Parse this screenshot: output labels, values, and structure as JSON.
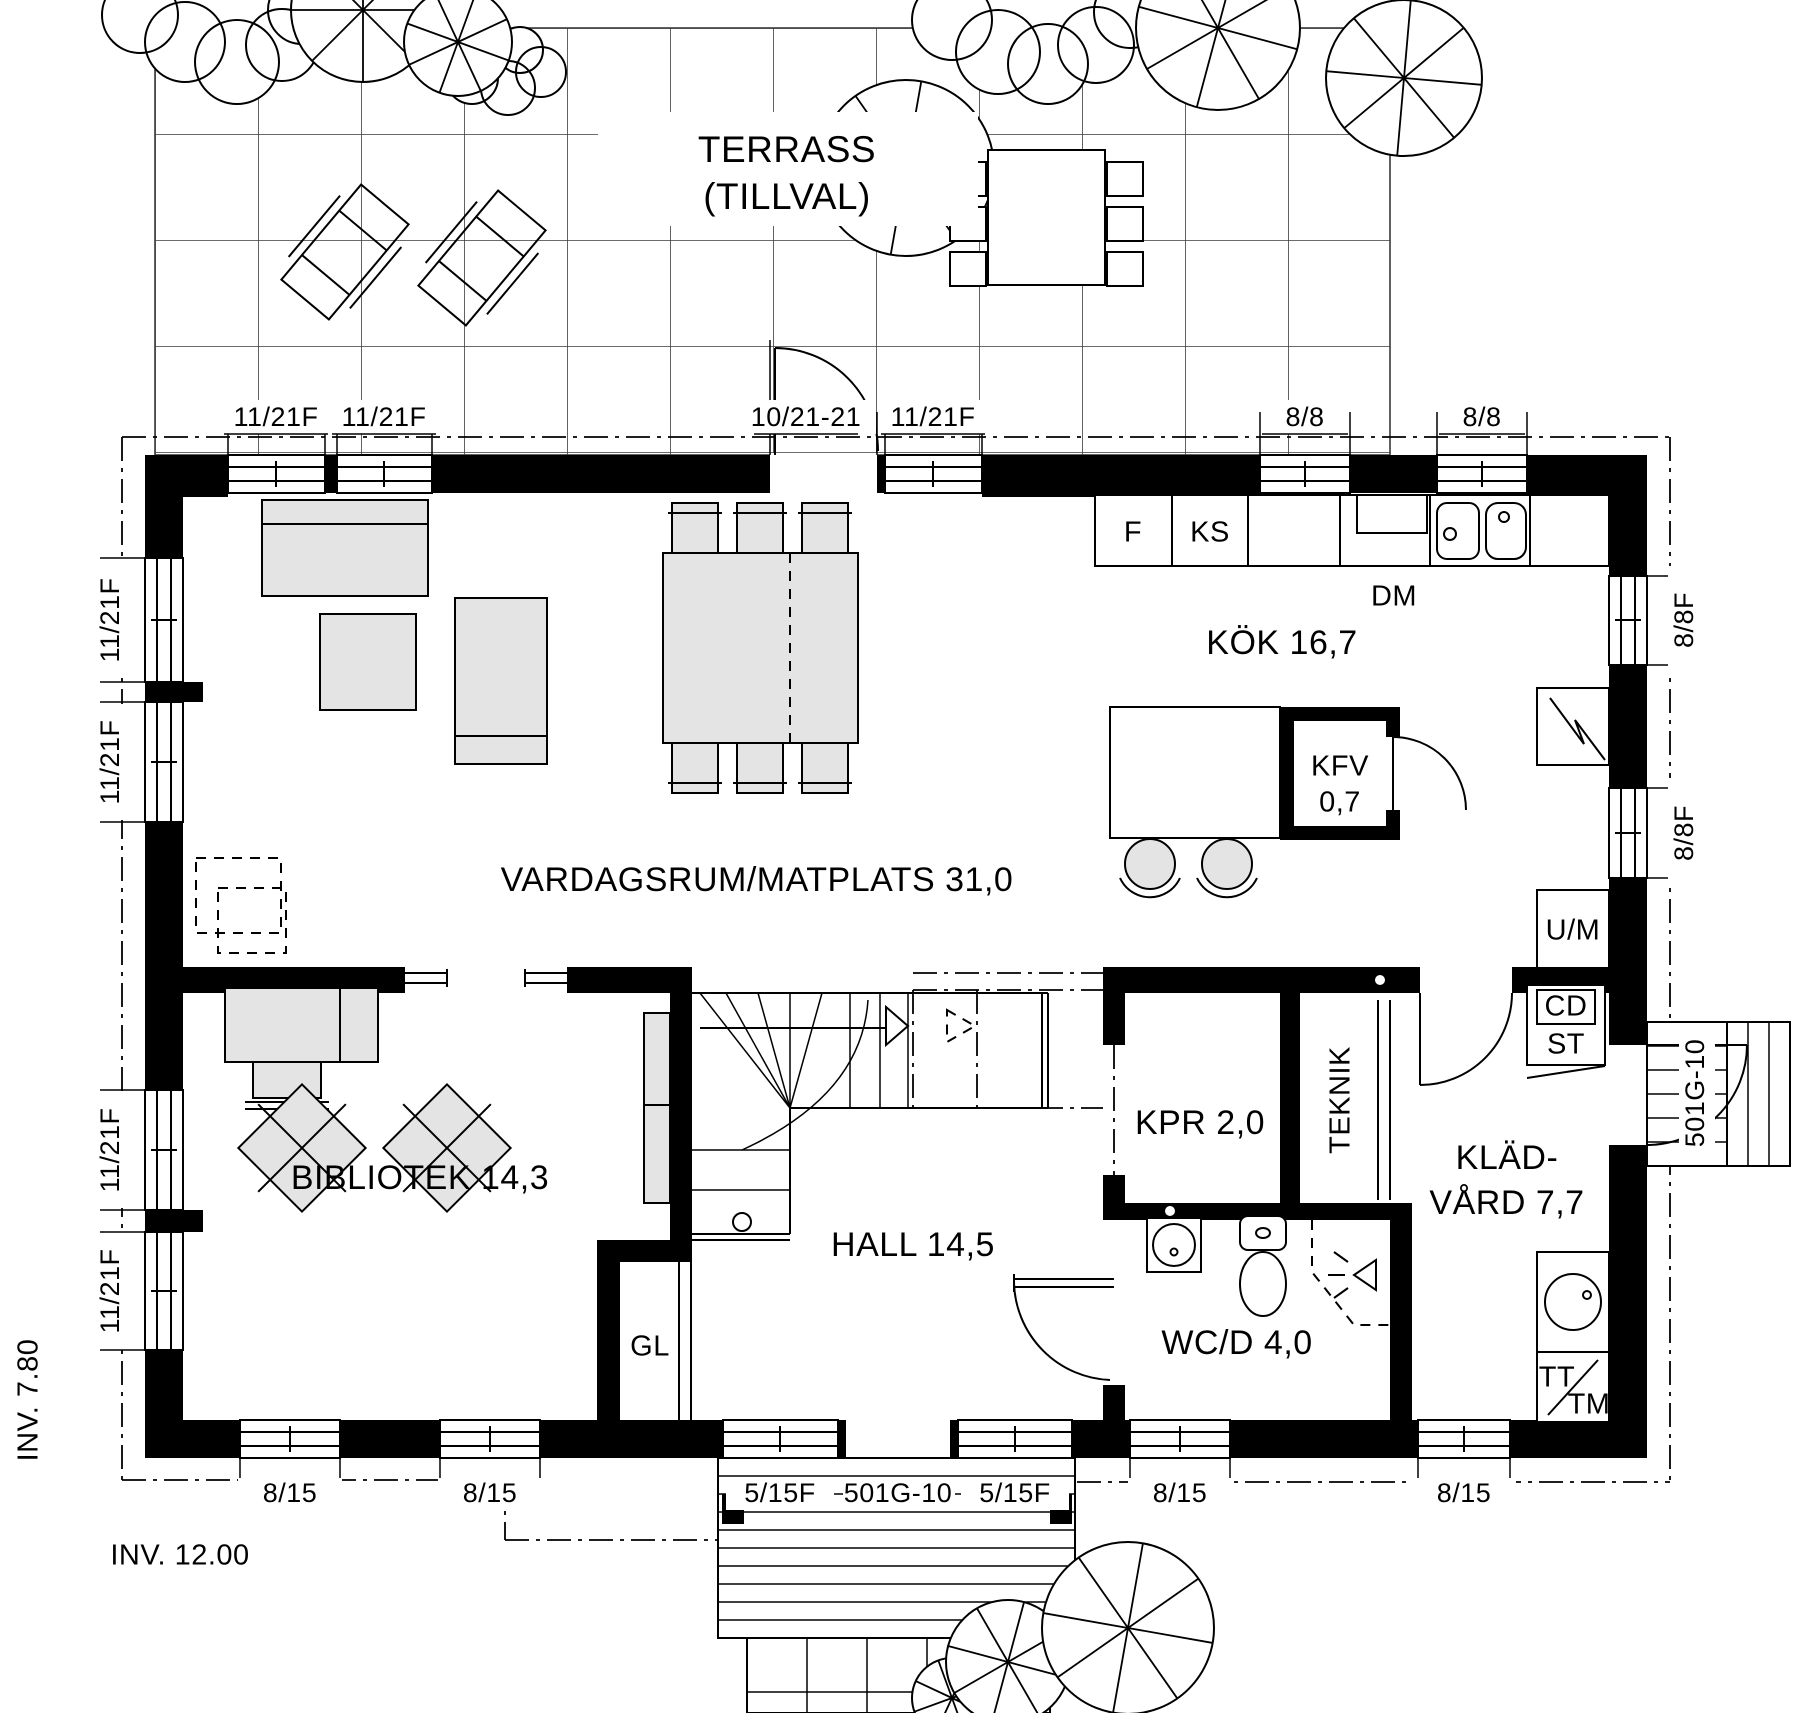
{
  "terrace": {
    "line1": "TERRASS",
    "line2": "(TILLVAL)"
  },
  "rooms": {
    "living": "VARDAGSRUM/MATPLATS 31,0",
    "kitchen": "KÖK 16,7",
    "library": "BIBLIOTEK 14,3",
    "hall": "HALL 14,5",
    "kpr": "KPR 2,0",
    "teknik": "TEKNIK",
    "kladvard1": "KLÄD-",
    "kladvard2": "VÅRD 7,7",
    "wc": "WC/D 4,0",
    "kfv1": "KFV",
    "kfv2": "0,7",
    "gl": "GL"
  },
  "appliances": {
    "f": "F",
    "ks": "KS",
    "dm": "DM",
    "um": "U/M",
    "cd": "CD",
    "st": "ST",
    "tt": "TT",
    "tm": "TM"
  },
  "windows": {
    "top1": "11/21F",
    "top2": "11/21F",
    "top_door": "10/21-21",
    "top3": "11/21F",
    "top4": "8/8",
    "top5": "8/8",
    "left1": "11/21F",
    "left2": "11/21F",
    "left3": "11/21F",
    "left4": "11/21F",
    "right1": "8/8F",
    "right2": "8/8F",
    "right_door": "501G-10",
    "bottom1": "8/15",
    "bottom2": "8/15",
    "bottom3": "5/15F",
    "bottom_door": "501G-10",
    "bottom4": "5/15F",
    "bottom5": "8/15",
    "bottom6": "8/15"
  },
  "dimensions": {
    "depth": "INV. 7.80",
    "width": "INV. 12.00"
  }
}
